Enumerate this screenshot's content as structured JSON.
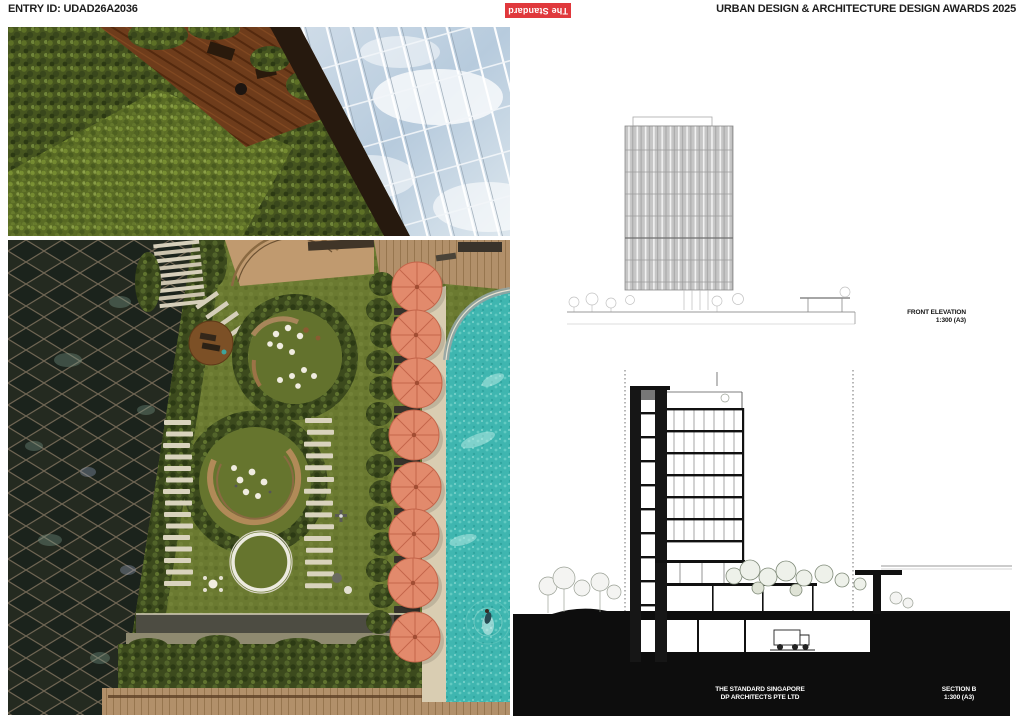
{
  "header": {
    "entry_id": "ENTRY ID: UDAD26A2036",
    "logo_text": "The Standard",
    "title": "URBAN DESIGN & ARCHITECTURE DESIGN AWARDS 2025"
  },
  "elevation": {
    "label": "FRONT ELEVATION",
    "scale": "1:300 (A3)"
  },
  "section": {
    "label": "SECTION B",
    "scale": "1:300 (A3)"
  },
  "credits": {
    "project": "THE STANDARD SINGAPORE",
    "firm": "DP ARCHITECTS PTE LTD"
  },
  "colors": {
    "logo_red": "#e0383c",
    "ink": "#1d1d1d",
    "pool_teal": "#3fb6b0",
    "umbrella_coral": "#e28a6c",
    "foliage_green": "#46551f",
    "ground_poche": "#0d0d0d"
  }
}
